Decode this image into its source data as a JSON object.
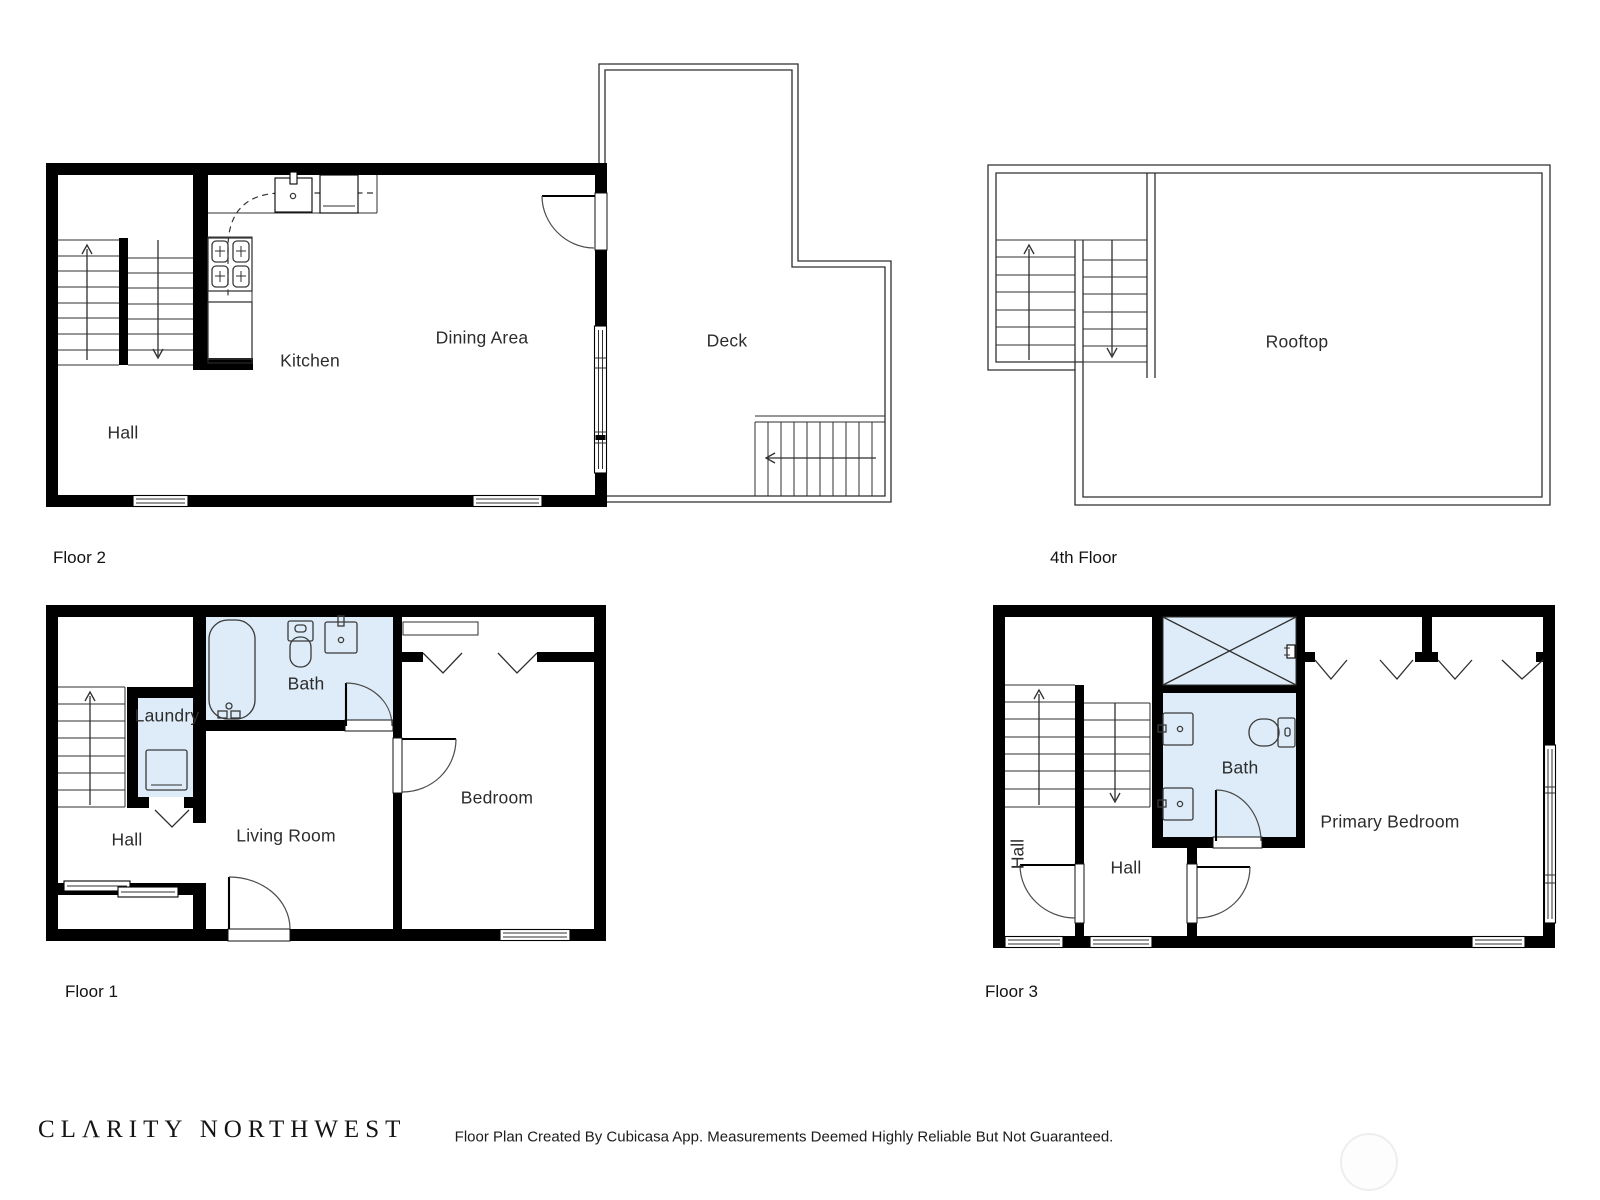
{
  "colors": {
    "wall": "#000000",
    "thin_line": "#2f2f2f",
    "wet_room_fill": "#ddecf8",
    "page_background": "#ffffff",
    "watermark": "#eeeeee"
  },
  "branding": {
    "logo_text": "CLΛRITY NORTHWEST",
    "disclaimer": "Floor Plan Created By Cubicasa App. Measurements Deemed Highly Reliable But Not Guaranteed."
  },
  "floors": {
    "floor2": {
      "title": "Floor 2",
      "rooms": {
        "hall": "Hall",
        "kitchen": "Kitchen",
        "dining_area": "Dining Area",
        "deck": "Deck"
      }
    },
    "floor4": {
      "title": "4th Floor",
      "rooms": {
        "rooftop": "Rooftop"
      }
    },
    "floor1": {
      "title": "Floor 1",
      "rooms": {
        "hall": "Hall",
        "laundry": "Laundry",
        "bath": "Bath",
        "living_room": "Living Room",
        "bedroom": "Bedroom"
      }
    },
    "floor3": {
      "title": "Floor 3",
      "rooms": {
        "hall_left": "Hall",
        "hall": "Hall",
        "bath": "Bath",
        "primary_bedroom": "Primary Bedroom"
      }
    }
  }
}
